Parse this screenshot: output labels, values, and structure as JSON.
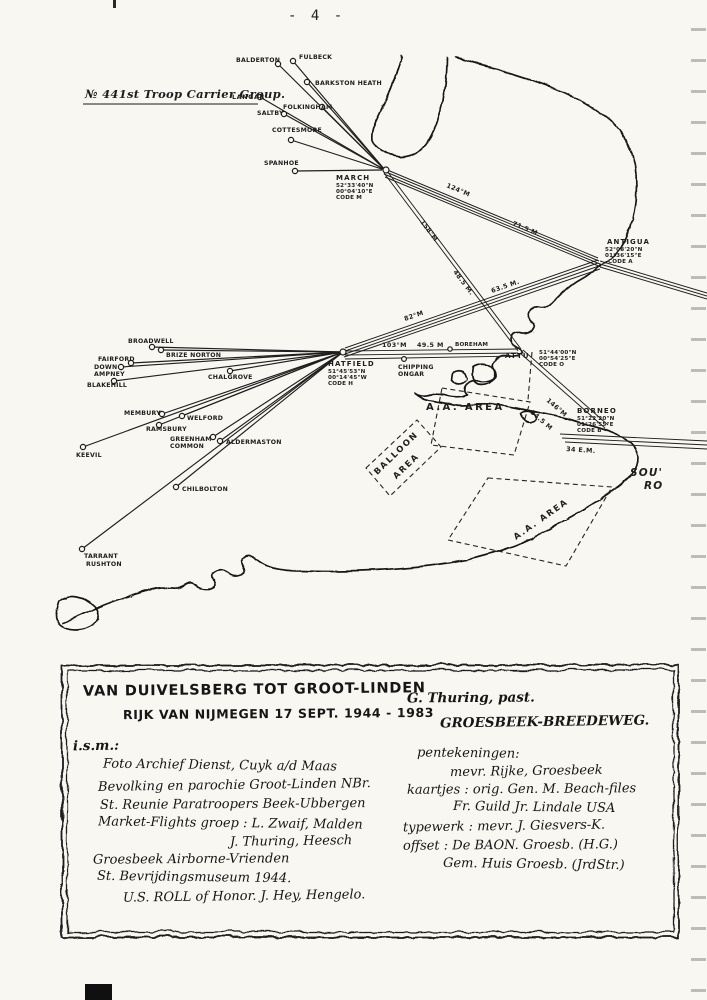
{
  "page": {
    "number": "- 4 -"
  },
  "map": {
    "group": {
      "title": "№ 441st Troop Carrier Group.",
      "base": "LANGAR"
    },
    "airfields": {
      "balderton": "BALDERTON",
      "fulbeck": "FULBECK",
      "barkston": "BARKSTON HEATH",
      "folkingham": "FOLKINGHAM",
      "saltby": "SALTBY",
      "cottesmore": "COTTESMORE",
      "spanhoe": "SPANHOE",
      "broadwell": "BROADWELL",
      "brize_norton": "BRIZE NORTON",
      "fairford": "FAIRFORD",
      "down1": "DOWN",
      "down2": "AMPNEY",
      "blakehill": "BLAKEHILL",
      "chalgrove": "CHALGROVE",
      "membury": "MEMBURY",
      "welford": "WELFORD",
      "ramsbury": "RAMSBURY",
      "greenham1": "GREENHAM",
      "greenham2": "COMMON",
      "aldermaston": "ALDERMASTON",
      "keevil": "KEEVIL",
      "chilbolton": "CHILBOLTON",
      "tarrant1": "TARRANT",
      "tarrant2": "RUSHTON",
      "boreham": "BOREHAM",
      "chipping1": "CHIPPING",
      "chipping2": "ONGAR"
    },
    "checkpoints": {
      "march": {
        "name": "MARCH",
        "lat": "52°33'40\"N",
        "lon": "00°04'10\"E",
        "code": "CODE M"
      },
      "antigua": {
        "name": "ANTIGUA",
        "lat": "52°08'20\"N",
        "lon": "01°36'15\"E",
        "code": "CODE A"
      },
      "hatfield": {
        "name": "HATFIELD",
        "lat": "51°45'53\"N",
        "lon": "00°14'45\"W",
        "code": "CODE H"
      },
      "attu": {
        "name": "ATTU",
        "lat": "51°44'00\"N",
        "lon": "00°54'25\"E",
        "code": "CODE O"
      },
      "borneo": {
        "name": "BORNEO",
        "lat": "51°22'20\"N",
        "lon": "01°26'55\"E",
        "code": "CODE B"
      }
    },
    "route_labels": {
      "march_antigua_heading": "124°M",
      "march_antigua_dist": "71.5 M.",
      "march_attu_heading": "158°M",
      "march_attu_dist": "48.5 M.",
      "hatfield_antigua_heading": "82°M",
      "hatfield_antigua_dist": "63.5 M.",
      "hatfield_attu_heading": "103°M",
      "hatfield_attu_dist": "49.5 M",
      "attu_borneo_heading": "146°M",
      "attu_borneo_dist": "34.5 M",
      "borneo_east_dist": "34 E.M."
    },
    "areas": {
      "aa_north": "A.A. AREA",
      "aa_south": "A.A. AREA",
      "balloon1": "BALLOON",
      "balloon2": "AREA"
    },
    "margin_note": {
      "line1": "SOU'",
      "line2": "RO"
    }
  },
  "credits": {
    "title_line1": "VAN DUIVELSBERG TOT GROOT-LINDEN",
    "title_line2": "RIJK VAN NIJMEGEN 17 SEPT. 1944 - 1983",
    "ism": "i.s.m.:",
    "left": [
      "Foto Archief Dienst, Cuyk a/d Maas",
      "Bevolking en parochie Groot-Linden NBr.",
      "St. Reunie Paratroopers Beek-Ubbergen",
      "Market-Flights groep : L. Zwaif, Malden",
      "J. Thuring, Heesch",
      "Groesbeek Airborne-Vrienden",
      "St. Bevrijdingsmuseum 1944.",
      "U.S. ROLL of Honor. J. Hey, Hengelo."
    ],
    "author_line1": "G. Thuring, past.",
    "author_line2": "GROESBEEK-BREEDEWEG.",
    "right": [
      "pentekeningen:",
      "mevr. Rijke, Groesbeek",
      "kaartjes : orig. Gen. M. Beach-files",
      "Fr. Guild Jr. Lindale USA",
      "typewerk : mevr. J. Giesvers-K.",
      "offset : De BAON. Groesb. (H.G.)",
      "Gem. Huis Groesb. (JrdStr.)"
    ]
  }
}
